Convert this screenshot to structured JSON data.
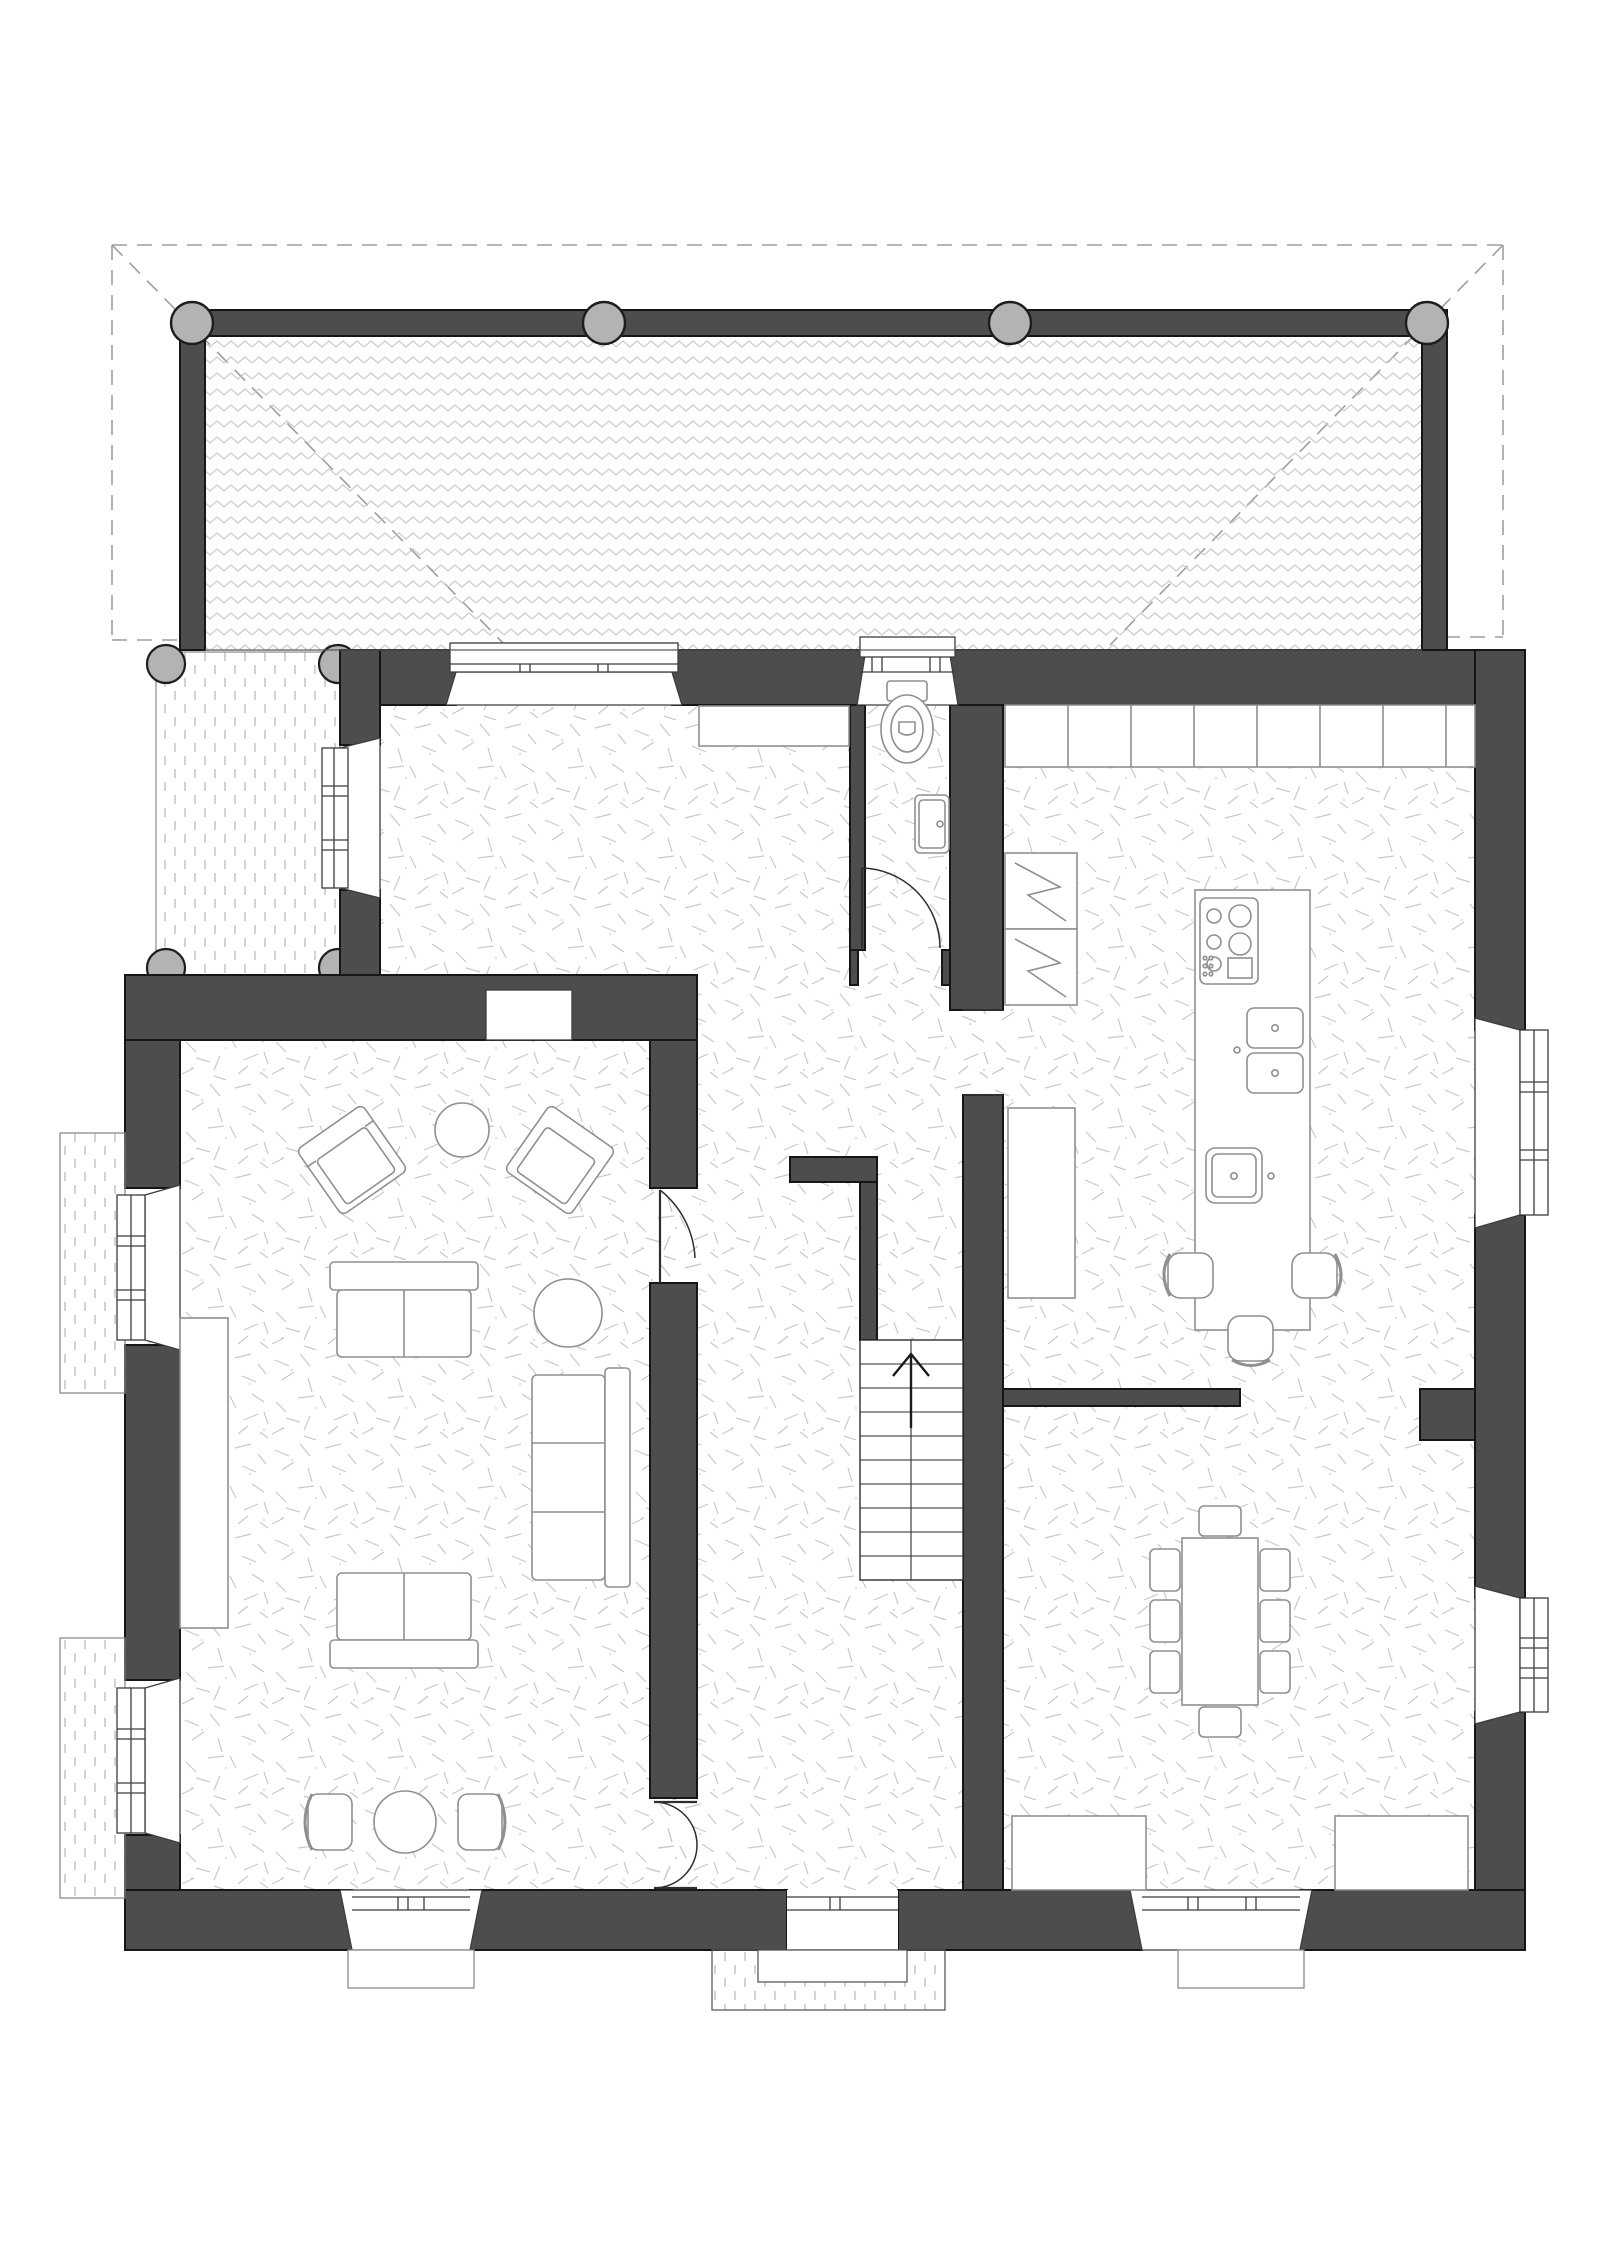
{
  "document": {
    "type": "architectural-floor-plan",
    "view": "ground-floor plan, top-down",
    "visible_text": "none"
  },
  "colors": {
    "background": "#ffffff",
    "wall": "#4d4d4d",
    "wallOutline": "#161616",
    "deckHatch": "#c4c4c4",
    "floorHatch": "#c9c9c9",
    "paving": "#b3b3b3",
    "column": "#b3b3b3",
    "columnOutline": "#1d1d1d",
    "roofDash": "#9e9e9e",
    "furnitureLine": "#8f8f8f",
    "windowLine": "#3c3c3c",
    "doorLine": "#2e2e2e",
    "thinLine": "#5a5a5a"
  },
  "plan": {
    "rooms": [
      {
        "name": "veranda-deck",
        "finish": "timber-deck zigzag hatch",
        "columns": 4
      },
      {
        "name": "side-terrace",
        "finish": "paving dashed hatch",
        "columns": 4
      },
      {
        "name": "sitting-hall-north",
        "features": [
          "bay-window-north",
          "window-west",
          "built-in-cupboard"
        ]
      },
      {
        "name": "wc",
        "fixtures": [
          "toilet",
          "hand-basin",
          "door-swing"
        ]
      },
      {
        "name": "entrance-hall",
        "features": [
          "staircase-up",
          "front-door-south",
          "entry-steps"
        ]
      },
      {
        "name": "living-room",
        "features": [
          "two-west-windows",
          "south-bay-window",
          "fireplace-niche",
          "window-bench"
        ]
      },
      {
        "name": "kitchen",
        "features": [
          "north-counter-run",
          "island",
          "fridge-freezer",
          "pantry-unit",
          "east-window"
        ]
      },
      {
        "name": "dining-area",
        "features": [
          "east-window",
          "south-window",
          "two-sideboards"
        ]
      }
    ],
    "furniture": [
      {
        "name": "armchair",
        "count": 2,
        "room": "living-room"
      },
      {
        "name": "round-side-table",
        "count": 1,
        "room": "living-room"
      },
      {
        "name": "two-seat-sofa",
        "count": 2,
        "room": "living-room"
      },
      {
        "name": "three-seat-sofa",
        "count": 1,
        "room": "living-room"
      },
      {
        "name": "round-coffee-table",
        "count": 1,
        "room": "living-room"
      },
      {
        "name": "bistro-table-with-two-chairs",
        "count": 1,
        "room": "living-room"
      },
      {
        "name": "window-bench",
        "count": 1,
        "room": "living-room"
      },
      {
        "name": "kitchen-island-with-cooktop-and-sinks",
        "count": 1,
        "room": "kitchen"
      },
      {
        "name": "bar-stool",
        "count": 3,
        "room": "kitchen"
      },
      {
        "name": "dining-table",
        "count": 1,
        "room": "dining-area"
      },
      {
        "name": "dining-chair",
        "count": 8,
        "room": "dining-area"
      },
      {
        "name": "sideboard",
        "count": 2,
        "room": "dining-area"
      }
    ],
    "stairs": {
      "treads": 10,
      "direction": "up",
      "arrow": "north"
    },
    "doors": [
      {
        "name": "front-door",
        "wall": "south"
      },
      {
        "name": "living-room-door",
        "wall": "hall-west"
      },
      {
        "name": "living-room-double-door",
        "wall": "hall-west-south"
      },
      {
        "name": "wc-door",
        "wall": "wc-south"
      },
      {
        "name": "kitchen-opening",
        "wall": "spine"
      }
    ],
    "windows": {
      "north": 2,
      "west": 3,
      "south": 2,
      "east": 2
    }
  }
}
